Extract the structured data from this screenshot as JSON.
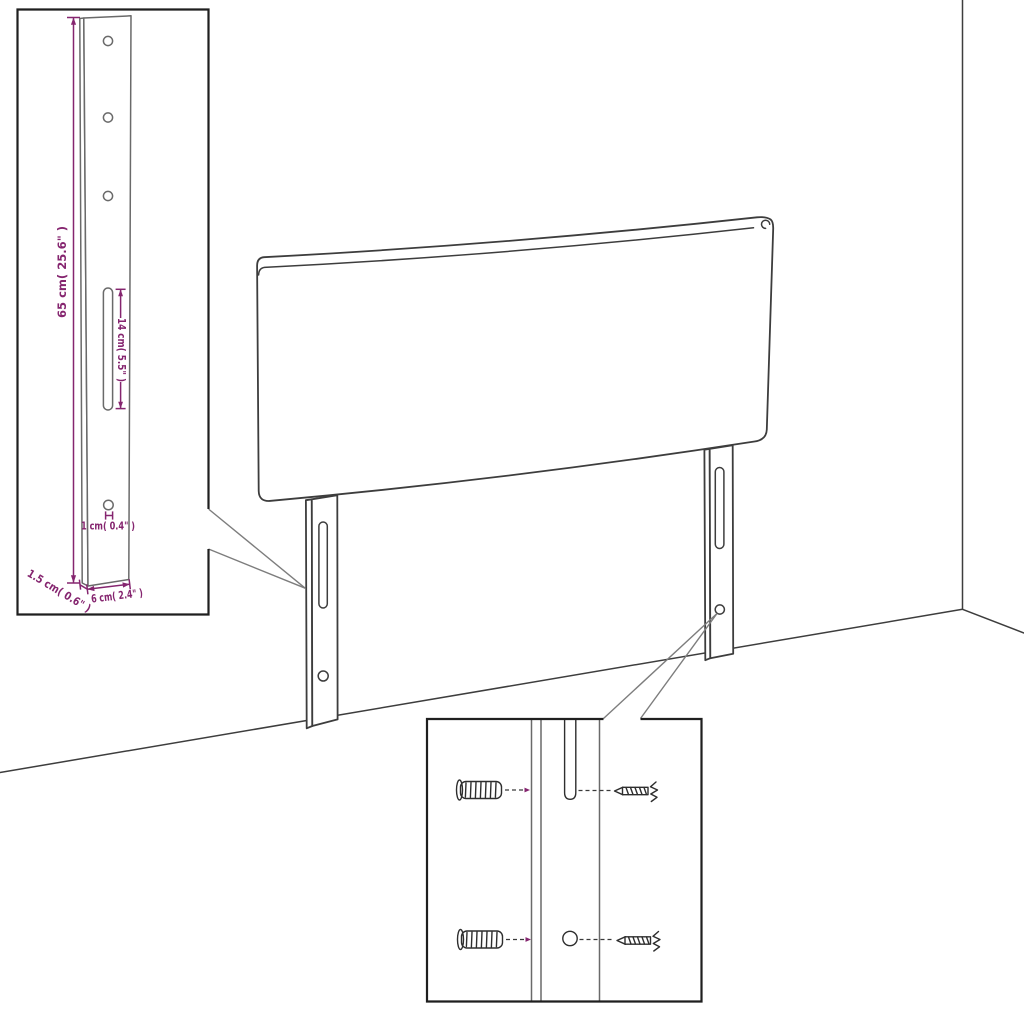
{
  "diagram": {
    "kind": "furniture-assembly-dimension-diagram",
    "subject": "upholstered headboard with two wall-mount legs, shown against a room corner",
    "insets": {
      "leg_detail": "enlarged leg with drill holes, slot and dimensions",
      "mounting_detail": "wall plugs and screws aligned with leg slot and hole"
    }
  },
  "colors": {
    "accent": "#85256f",
    "line": "#3d3d3d",
    "detail": "#6a6a6a",
    "border": "#1f1f1f",
    "background": "#ffffff"
  },
  "dimensions": {
    "leg_height": "65 cm( 25.6\" )",
    "slot_height": "14 cm( 5.5\" )",
    "hole_diameter": "1 cm( 0.4\" )",
    "leg_depth": "1.5 cm( 0.6\" )",
    "leg_width": "6 cm( 2.4\" )"
  }
}
